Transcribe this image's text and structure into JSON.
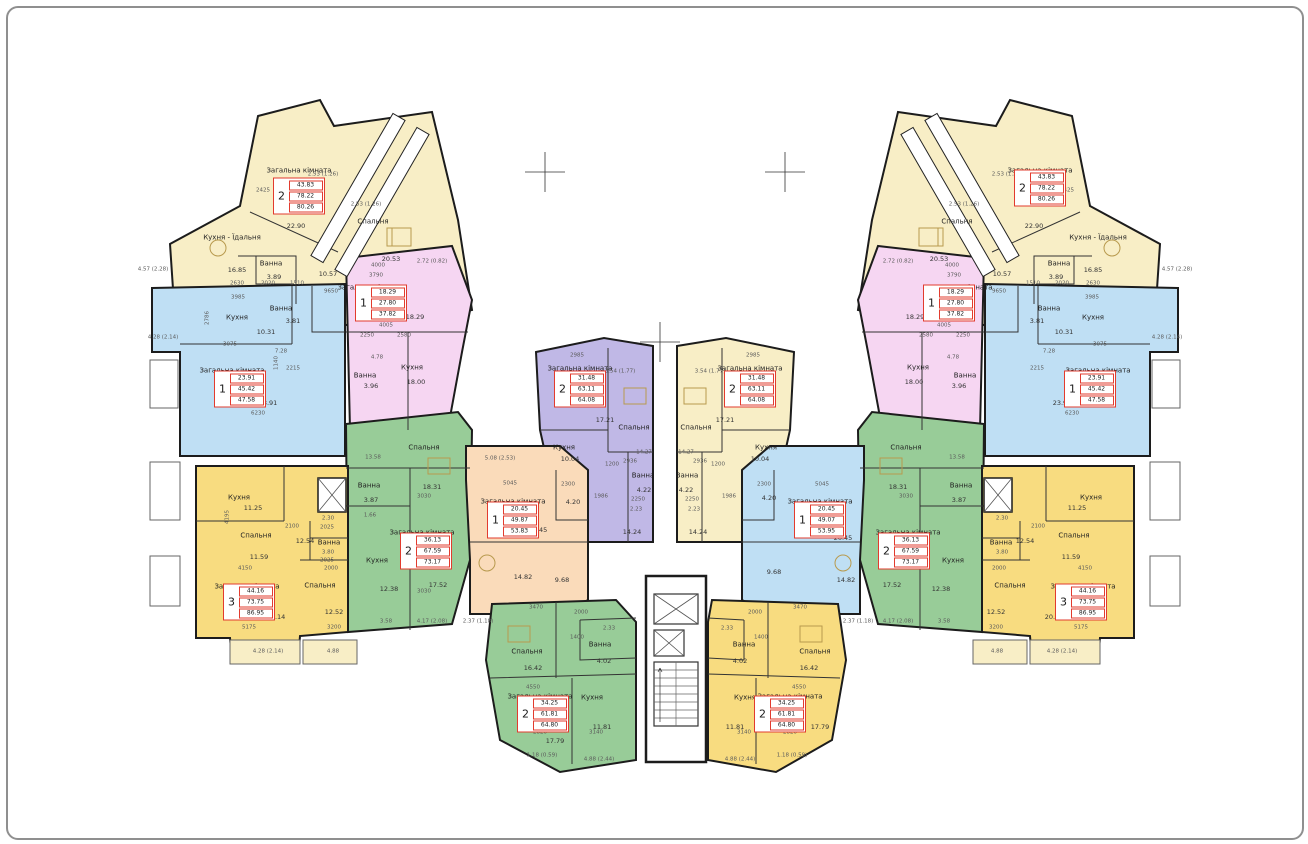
{
  "plan_title": "apartment-building-floor-plan",
  "rooms": {
    "living": "Загальна кімната",
    "kitchen": "Кухня",
    "kitchen_dining": "Кухня - Їдальня",
    "bedroom": "Спальня",
    "bath": "Ванна"
  },
  "tables": {
    "cream": {
      "n": "2",
      "a1": "43.83",
      "a2": "78.22",
      "a3": "80.26"
    },
    "pink": {
      "n": "1",
      "a1": "18.29",
      "a2": "27.80",
      "a3": "37.82"
    },
    "blue_side": {
      "n": "1",
      "a1": "23.91",
      "a2": "45.42",
      "a3": "47.58"
    },
    "green_side": {
      "n": "2",
      "a1": "36.13",
      "a2": "67.59",
      "a3": "73.17"
    },
    "yellow3": {
      "n": "3",
      "a1": "44.16",
      "a2": "73.75",
      "a3": "86.95"
    },
    "purple": {
      "n": "2",
      "a1": "31.48",
      "a2": "63.11",
      "a3": "64.08"
    },
    "center_yellow": {
      "n": "2",
      "a1": "31.48",
      "a2": "63.11",
      "a3": "64.08"
    },
    "peach": {
      "n": "1",
      "a1": "20.45",
      "a2": "49.87",
      "a3": "53.83"
    },
    "center_blue": {
      "n": "1",
      "a1": "20.45",
      "a2": "49.07",
      "a3": "53.95"
    },
    "bottom_green": {
      "n": "2",
      "a1": "34.25",
      "a2": "61.81",
      "a3": "64.80"
    },
    "bottom_yellow": {
      "n": "2",
      "a1": "34.25",
      "a2": "61.81",
      "a3": "64.80"
    }
  },
  "areas": {
    "cream_kd": "16.85",
    "cream_bath": "3.89",
    "cream_bedroom": "20.53",
    "pink_living": "18.29",
    "pink_kitchen": "18.00",
    "pink_bath": "3.96",
    "blue_kitchen": "10.31",
    "blue_bath": "3.81",
    "blue_living": "23.91",
    "green_bedroom": "18.31",
    "green_bath": "3.87",
    "green_kitchen": "12.38",
    "green_living": "17.52",
    "y3_kitchen": "11.25",
    "y3_bedroom1": "11.59",
    "y3_bedroom2": "12.52",
    "y3_living": "20.14",
    "y3_hall": "12.54",
    "peach_living": "20.45",
    "peach_bath": "4.20",
    "peach_kitchen": "14.82",
    "peach_hall": "9.68",
    "purple_kitchen": "10.04",
    "purple_bedroom": "17.21",
    "purple_bath": "4.22",
    "purple_hall": "14.24",
    "bg_bedroom": "16.42",
    "bg_bath": "4.02",
    "bg_kitchen": "11.81",
    "bg_hall": "17.79",
    "cream_hall": "22.90",
    "cream_hall2": "10.57"
  },
  "dims": {
    "d253": "2.53 (1.26)",
    "d457": "4.57 (2.28)",
    "d272": "2.72 (0.82)",
    "d428": "4.28 (2.14)",
    "d488": "4.88",
    "d488b": "4.88 (2.44)",
    "d508": "5.08 (2.53)",
    "d237": "2.37 (1.18)",
    "d354": "3.54 (1.77)",
    "d417": "4.17 (2.08)",
    "d358": "3.58",
    "d118": "1.18 (0.59)",
    "d233": "2.33",
    "d223": "2.23",
    "d230": "2.30",
    "d380": "3.80",
    "d478": "4.78",
    "d728": "7.28",
    "d1427": "14.27",
    "d166": "1.66",
    "d1358": "13.58",
    "m3790": "3790",
    "m4005": "4005",
    "m2250": "2250",
    "m2580": "2580",
    "m3985": "3985",
    "m2786": "2786",
    "m3075": "3075",
    "m6230": "6230",
    "m2215": "2215",
    "m1140": "1140",
    "m3030": "3030",
    "m2100": "2100",
    "m2025": "2025",
    "m2000": "2000",
    "m4150": "4150",
    "m4195": "4195",
    "m5175": "5175",
    "m3200": "3200",
    "m5045": "5045",
    "m2300": "2300",
    "m2985": "2985",
    "m2936": "2936",
    "m1200": "1200",
    "m1986": "1986",
    "m3470": "3470",
    "m1400": "1400",
    "m4550": "4550",
    "m2820": "2820",
    "m3140": "3140",
    "m2630": "2630",
    "m2020": "2020",
    "m1510": "1510",
    "m9650": "9650",
    "m8560": "8560",
    "m2425": "2425",
    "m4000": "4000"
  },
  "colors": {
    "cream": "#f8eec6",
    "pink": "#f6d6f2",
    "blue": "#bfdff4",
    "green": "#98cc98",
    "yellow": "#f8dc80",
    "purple": "#c0b8e6",
    "peach": "#fadbba",
    "wall": "#1c1c1c",
    "table_red": "#e23b2e"
  }
}
